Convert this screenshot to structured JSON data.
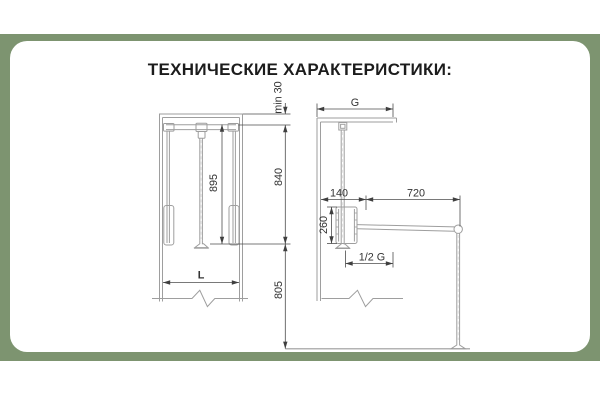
{
  "title": "ТЕХНИЧЕСКИЕ ХАРАКТЕРИСТИКИ:",
  "colors": {
    "frame_green": "#7d9470",
    "panel_white": "#ffffff",
    "structure_line": "#9e9e9e",
    "dimension_line": "#4d4d4d",
    "label_text": "#333333",
    "title_text": "#1c1c1c"
  },
  "front_view": {
    "labels": {
      "min_top_clearance": "min 30",
      "rod_length": "895",
      "rail_to_hook": "840",
      "inner_width": "L",
      "below_height": "805"
    }
  },
  "side_view": {
    "labels": {
      "depth": "G",
      "wall_offset": "140",
      "arm_reach": "720",
      "body_height": "260",
      "half_depth": "1/2 G"
    }
  }
}
